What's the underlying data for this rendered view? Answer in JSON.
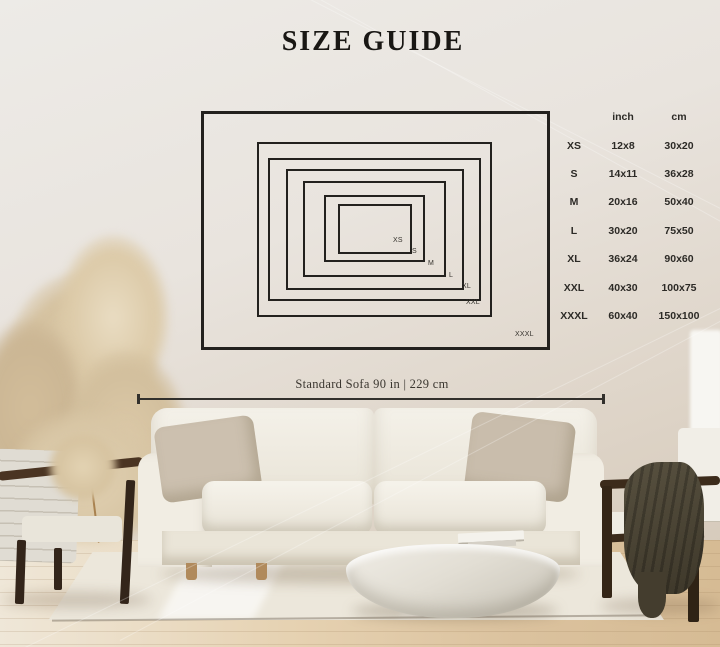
{
  "title": "SIZE GUIDE",
  "size_table": {
    "col_headers": {
      "inch": "inch",
      "cm": "cm"
    },
    "rows": [
      {
        "label": "XS",
        "inch": "12x8",
        "cm": "30x20"
      },
      {
        "label": "S",
        "inch": "14x11",
        "cm": "36x28"
      },
      {
        "label": "M",
        "inch": "20x16",
        "cm": "50x40"
      },
      {
        "label": "L",
        "inch": "30x20",
        "cm": "75x50"
      },
      {
        "label": "XL",
        "inch": "36x24",
        "cm": "90x60"
      },
      {
        "label": "XXL",
        "inch": "40x30",
        "cm": "100x75"
      },
      {
        "label": "XXXL",
        "inch": "60x40",
        "cm": "150x100"
      }
    ]
  },
  "sofa_dimension_label": "Standard Sofa 90 in | 229 cm",
  "colors": {
    "ink": "#23211e",
    "wall": "#e8e3dc",
    "sofa": "#f1ede4",
    "wood_frame": "#43301f",
    "wood_floor": "#dcc5a3"
  }
}
